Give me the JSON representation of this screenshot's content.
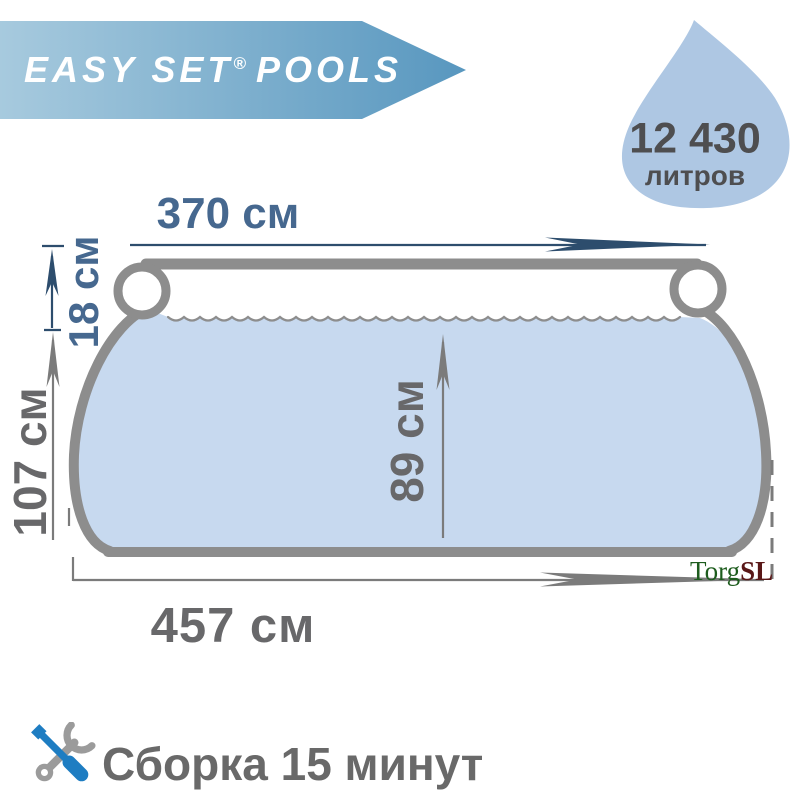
{
  "banner": {
    "brand": "EASY SET",
    "registered_mark": "®",
    "brand_suffix": "POOLS"
  },
  "volume_badge": {
    "value": "12 430",
    "unit": "литров"
  },
  "dimensions": {
    "top_width": "370 см",
    "ring_height": "18 см",
    "total_height": "107 см",
    "water_depth": "89 см",
    "base_width": "457 см"
  },
  "watermark": {
    "part_green": "Torg",
    "part_red": "SL"
  },
  "footer": {
    "assembly_text": "Сборка 15 минут"
  },
  "colors": {
    "banner_gradient_start": "#a7cade",
    "banner_gradient_end": "#5897bf",
    "drop_fill": "#aec7e3",
    "water_fill": "#c7d9ef",
    "pool_outline": "#8d8d8d",
    "dim_slate_line": "#2d4d6d",
    "dim_gray_line": "#7b7b7b",
    "dim_slate_text": "#46688f",
    "dim_gray_text": "#68686a",
    "icon_blue": "#1e7dc2",
    "icon_gray": "#9b9b9b"
  }
}
